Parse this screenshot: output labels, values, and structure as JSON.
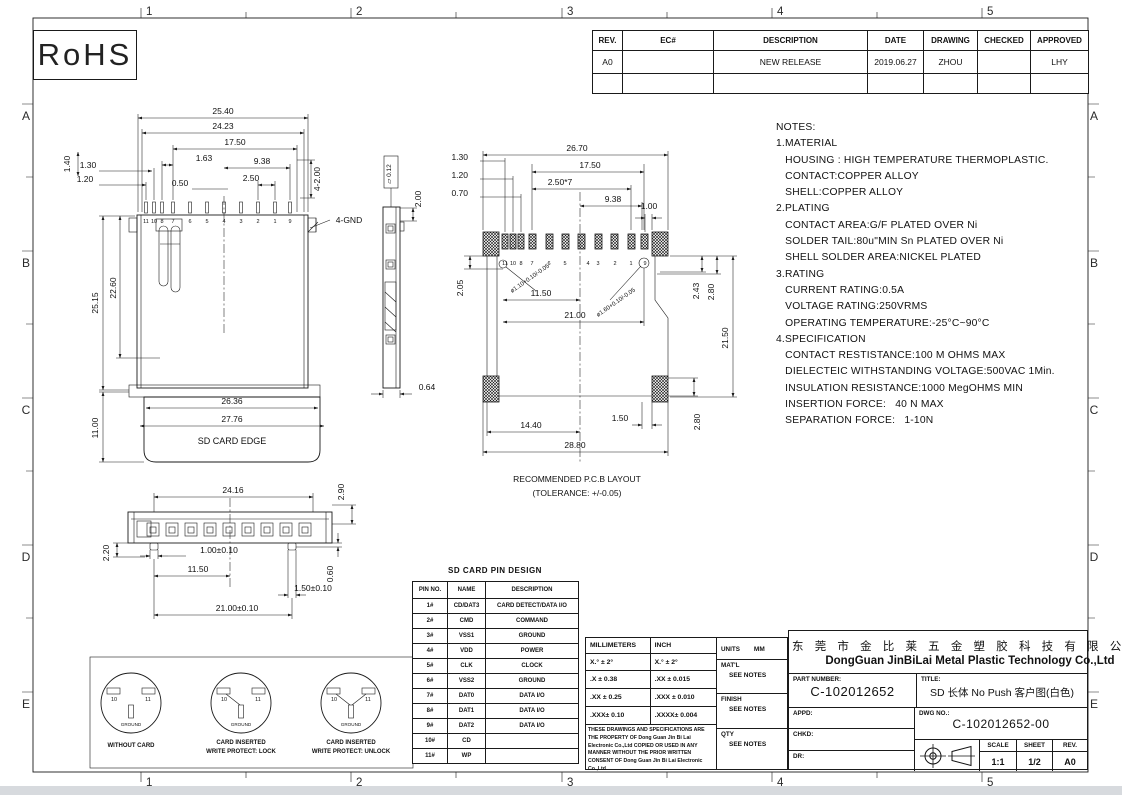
{
  "colors": {
    "ink": "#1a1a1a",
    "paper": "#ffffff",
    "footer_bar": "#d7dade"
  },
  "rohs": "RoHS",
  "grid": {
    "cols": [
      "1",
      "2",
      "3",
      "4",
      "5"
    ],
    "rows": [
      "A",
      "B",
      "C",
      "D",
      "E"
    ]
  },
  "revision_table": {
    "headers": [
      "REV.",
      "EC#",
      "DESCRIPTION",
      "DATE",
      "DRAWING",
      "CHECKED",
      "APPROVED"
    ],
    "row": {
      "rev": "A0",
      "ec": "",
      "description": "NEW RELEASE",
      "date": "2019.06.27",
      "drawing": "ZHOU",
      "checked": "",
      "approved": "LHY"
    }
  },
  "notes": {
    "text": "NOTES:\n1.MATERIAL\n   HOUSING : HIGH TEMPERATURE THERMOPLASTIC.\n   CONTACT:COPPER ALLOY\n   SHELL:COPPER ALLOY\n2.PLATING\n   CONTACT AREA:G/F PLATED OVER Ni\n   SOLDER TAIL:80u\"MIN Sn PLATED OVER Ni\n   SHELL SOLDER AREA:NICKEL PLATED\n3.RATING\n   CURRENT RATING:0.5A\n   VOLTAGE RATING:250VRMS\n   OPERATING TEMPERATURE:-25°C~90°C\n4.SPECIFICATION\n   CONTACT RESTISTANCE:100 M OHMS MAX\n   DIELECTEIC WITHSTANDING VOLTAGE:500VAC 1Min.\n   INSULATION RESISTANCE:1000 MegOHMS MIN\n   INSERTION FORCE:   40 N MAX\n   SEPARATION FORCE:   1-10N"
  },
  "pins": [
    "11",
    "10",
    "8",
    "7",
    "6",
    "5",
    "4",
    "3",
    "2",
    "1",
    "9"
  ],
  "views": {
    "front": {
      "card_edge": "SD CARD EDGE",
      "dims": {
        "w2540": "25.40",
        "w2423": "24.23",
        "w1750": "17.50",
        "w163": "1.63",
        "w938": "9.38",
        "w250": "2.50",
        "w050": "0.50",
        "w130": "1.30",
        "w120": "1.20",
        "h140": "1.40",
        "tails": "4-2.00",
        "gnd": "4-GND",
        "h2515": "25.15",
        "h2260": "22.60",
        "h1100": "11.00",
        "w2636": "26.36",
        "w2776": "27.76"
      }
    },
    "side": {
      "flat_label": "▱ 0.12",
      "d200": "2.00",
      "d064": "0.64"
    },
    "pcb": {
      "caption1": "RECOMMENDED P.C.B LAYOUT",
      "caption2": "(TOLERANCE: +/-0.05)",
      "dims": {
        "w2670": "26.70",
        "w1750": "17.50",
        "pitch": "2.50*7",
        "w938": "9.38",
        "l130": "1.30",
        "l120": "1.20",
        "l070": "0.70",
        "w100": "1.00",
        "h205": "2.05",
        "hole1": "ø1.10+0.10/-0.05",
        "hole2": "ø1.60+0.10/-0.05",
        "w1150": "11.50",
        "w2100": "21.00",
        "h243": "2.43",
        "h280": "2.80",
        "h2150": "21.50",
        "w1440": "14.40",
        "w150": "1.50",
        "w2880": "28.80",
        "hb280": "2.80"
      }
    },
    "bottom": {
      "dims": {
        "w2416": "24.16",
        "h290": "2.90",
        "h220": "2.20",
        "w100": "1.00±0.10",
        "w1150": "11.50",
        "w150": "1.50±0.10",
        "w2100": "21.00±0.10",
        "h060": "0.60"
      }
    },
    "switch": {
      "pad10": "10",
      "pad11": "11",
      "ground": "GROUND",
      "c1": "WITHOUT CARD",
      "c2a": "CARD INSERTED",
      "c2b": "WRITE PROTECT: LOCK",
      "c3a": "CARD INSERTED",
      "c3b": "WRITE PROTECT: UNLOCK"
    }
  },
  "pin_table": {
    "title": "SD CARD PIN DESIGN",
    "headers": [
      "PIN NO.",
      "NAME",
      "DESCRIPTION"
    ],
    "rows": [
      [
        "1#",
        "CD/DAT3",
        "CARD DETECT/DATA I/O"
      ],
      [
        "2#",
        "CMD",
        "COMMAND"
      ],
      [
        "3#",
        "VSS1",
        "GROUND"
      ],
      [
        "4#",
        "VDD",
        "POWER"
      ],
      [
        "5#",
        "CLK",
        "CLOCK"
      ],
      [
        "6#",
        "VSS2",
        "GROUND"
      ],
      [
        "7#",
        "DAT0",
        "DATA I/O"
      ],
      [
        "8#",
        "DAT1",
        "DATA I/O"
      ],
      [
        "9#",
        "DAT2",
        "DATA I/O"
      ],
      [
        "10#",
        "CD",
        ""
      ],
      [
        "11#",
        "WP",
        ""
      ]
    ]
  },
  "tolerance_table": {
    "col1": "MILLIMETERS",
    "col2": "INCH",
    "rows": [
      [
        "X.°  ±  2°",
        "X.°  ±  2°"
      ],
      [
        ".X  ±  0.38",
        ".XX  ±  0.015"
      ],
      [
        ".XX ±  0.25",
        ".XXX ±  0.010"
      ],
      [
        ".XXX±  0.10",
        ".XXXX±  0.004"
      ]
    ],
    "disclaimer": "THESE DRAWINGS AND SPECIFICATIONS ARE THE PROPERTY OF Dong Guan Jin Bi Lai Electronic Co.,Ltd COPIED OR USED IN ANY MANNER WITHOUT THE PRIOR WRITTEN CONSENT OF Dong Guan Jin Bi Lai Electronic Co.,Ltd"
  },
  "info_block": {
    "units_label": "UNITS",
    "units": "MM",
    "matl_label": "MAT'L",
    "matl": "SEE NOTES",
    "finish_label": "FINISH",
    "finish": "SEE NOTES",
    "qty_label": "QTY",
    "qty": "SEE NOTES"
  },
  "title_block": {
    "company_cn": "东 莞 市 金 比 莱 五 金 塑 胶 科 技 有 限 公 司",
    "company_en": "DongGuan JinBiLai Metal Plastic Technology Co.,Ltd",
    "part_number_label": "PART NUMBER:",
    "part_number": "C-102012652",
    "title_label": "TITLE:",
    "title": "SD 长体 No Push 客户图(白色)",
    "appd_label": "APPD:",
    "chkd_label": "CHKD:",
    "dr_label": "DR:",
    "dwg_no_label": "DWG NO.:",
    "dwg_no": "C-102012652-00",
    "scale_label": "SCALE",
    "scale": "1:1",
    "sheet_label": "SHEET",
    "sheet": "1/2",
    "rev_label": "REV.",
    "rev": "A0"
  }
}
